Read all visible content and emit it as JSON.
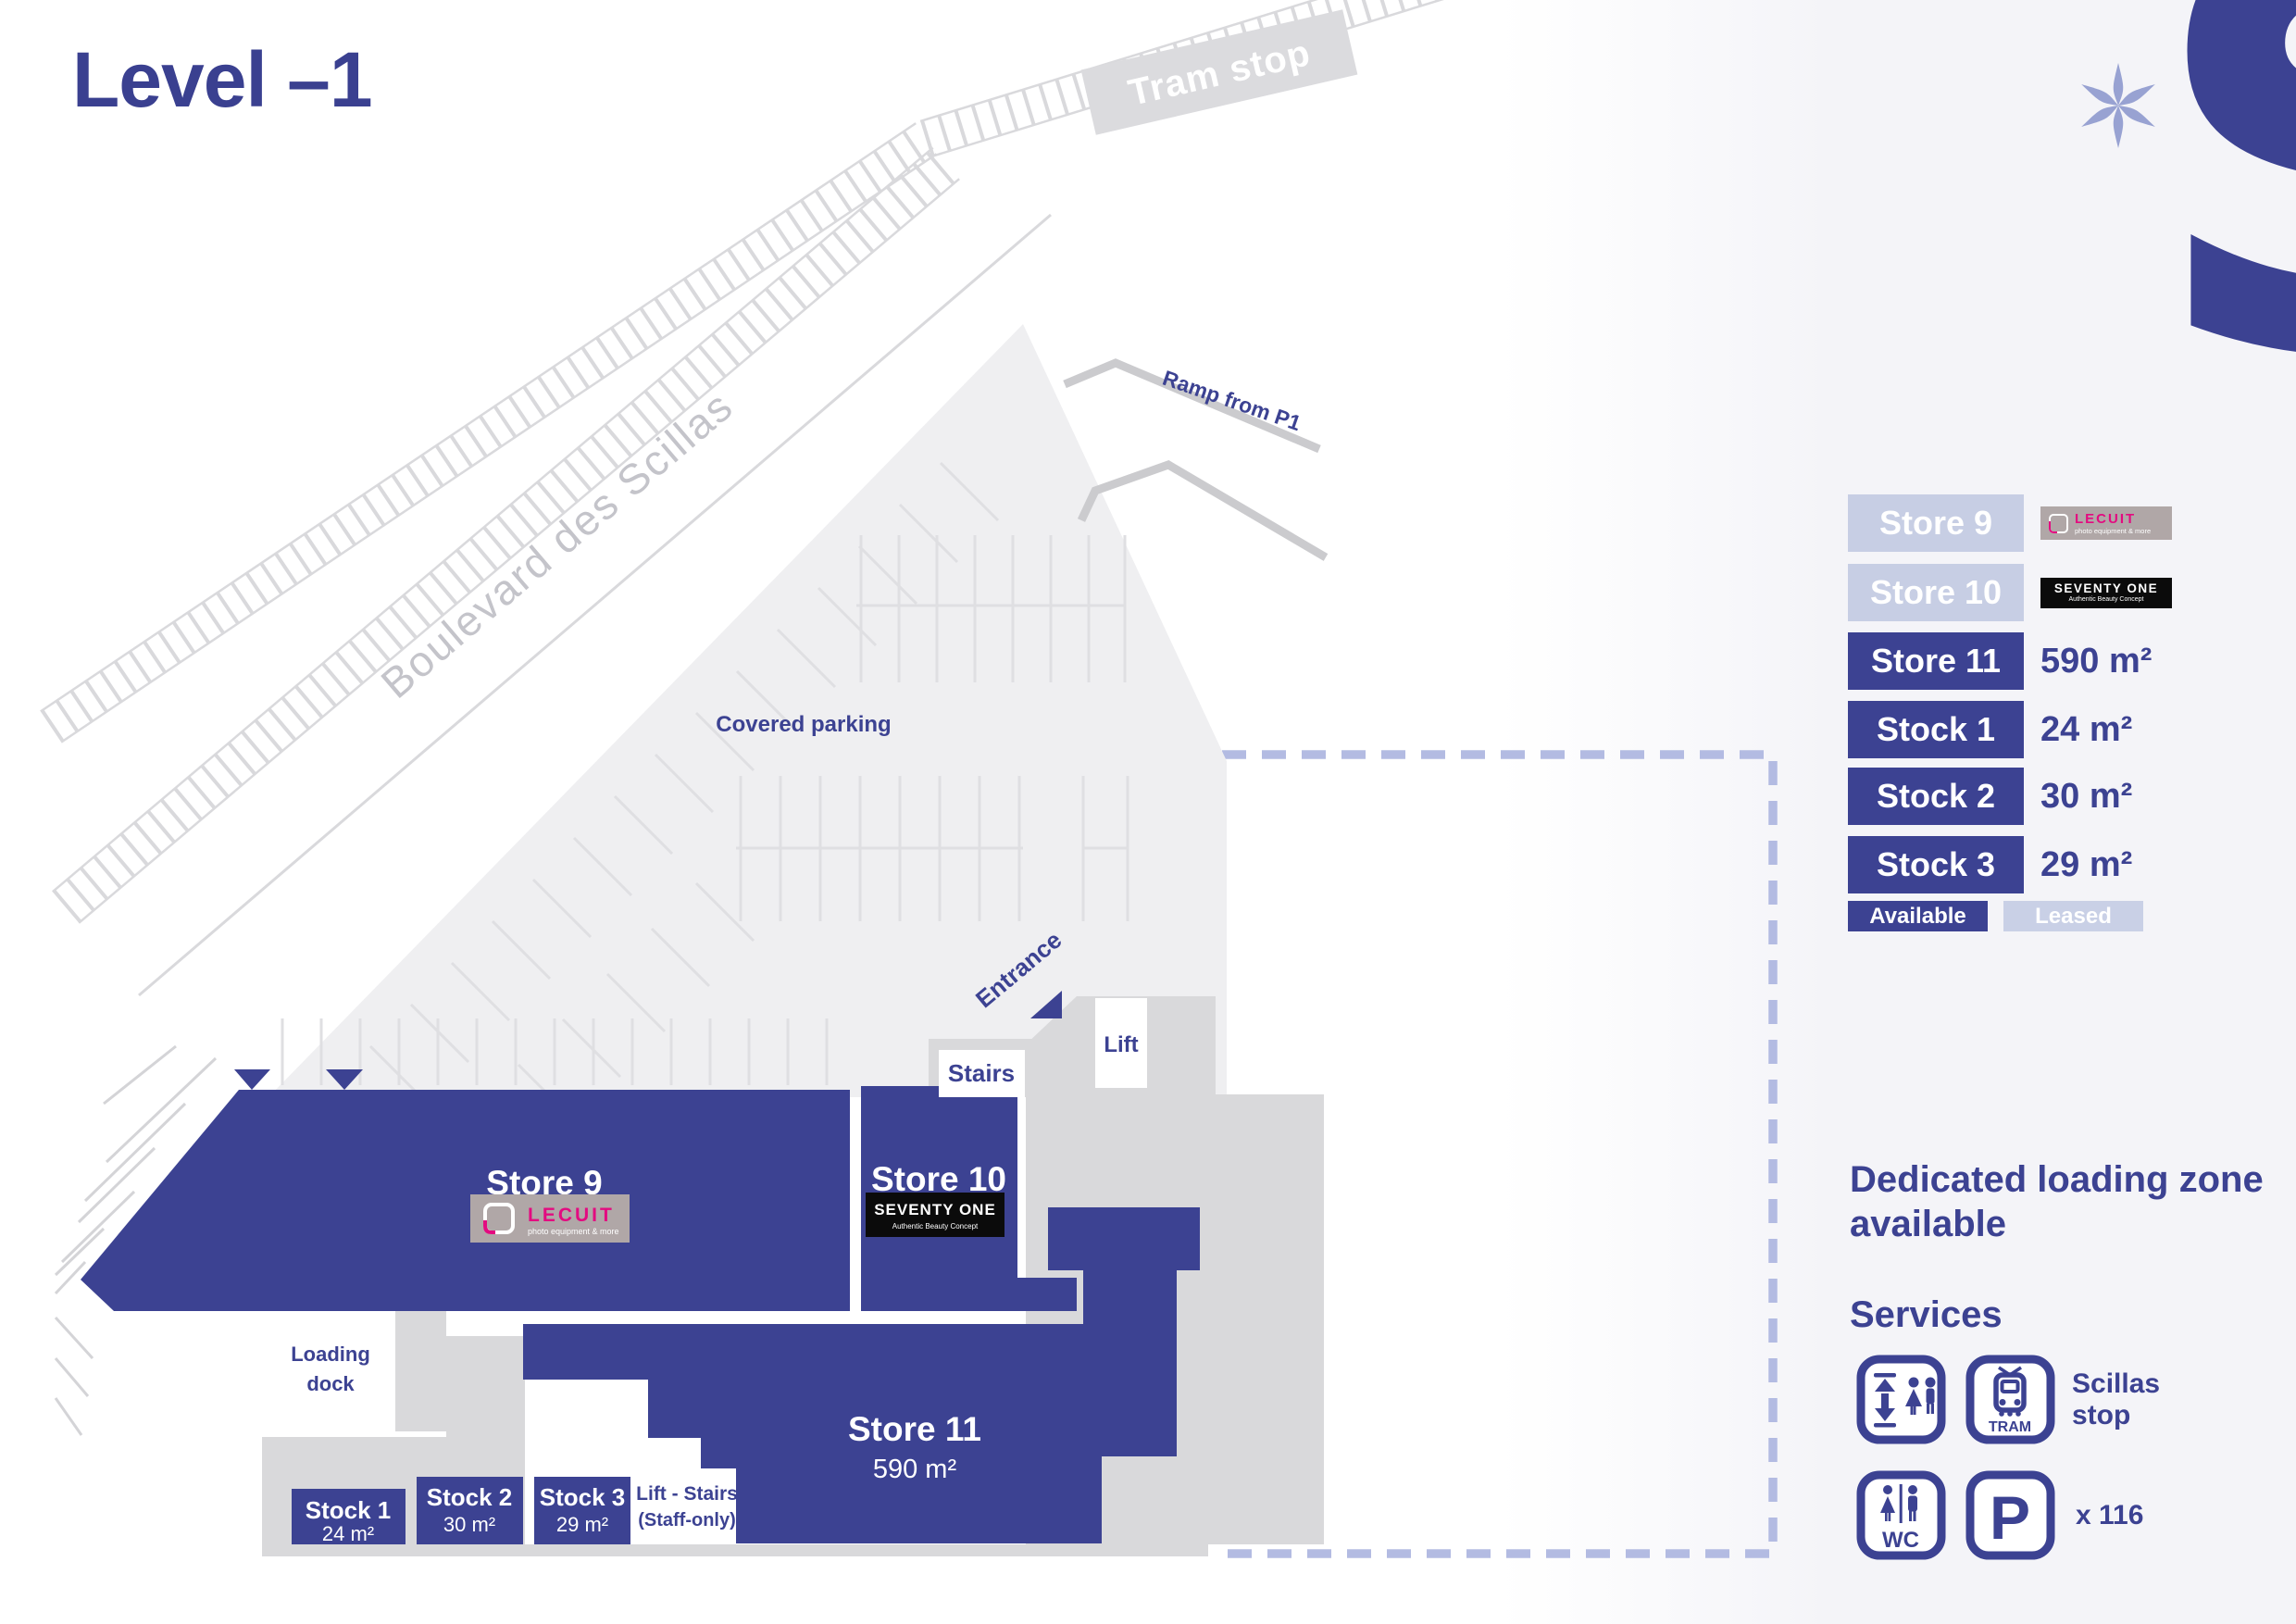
{
  "title": "Level –1",
  "logo": {
    "letter": "S"
  },
  "map": {
    "tram_stop": "Tram stop",
    "boulevard": "Boulevard des Scillas",
    "ramp": "Ramp from P1",
    "covered_parking": "Covered parking",
    "entrance": "Entrance",
    "stairs": "Stairs",
    "lift": "Lift",
    "loading_dock_line1": "Loading",
    "loading_dock_line2": "dock",
    "staff_lift_line1": "Lift - Stairs",
    "staff_lift_line2": "(Staff-only)",
    "store9": {
      "name": "Store 9"
    },
    "store10": {
      "name": "Store 10"
    },
    "store11": {
      "name": "Store 11",
      "area": "590 m²"
    },
    "stock1": {
      "name": "Stock 1",
      "area": "24 m²"
    },
    "stock2": {
      "name": "Stock 2",
      "area": "30 m²"
    },
    "stock3": {
      "name": "Stock 3",
      "area": "29 m²"
    }
  },
  "logos": {
    "lecuit": {
      "name": "LECUIT",
      "tagline": "photo equipment & more"
    },
    "seventyone": {
      "name": "SEVENTY ONE",
      "tagline": "Authentic Beauty Concept"
    }
  },
  "legend": {
    "rows": [
      {
        "label": "Store 9",
        "status": "leased"
      },
      {
        "label": "Store 10",
        "status": "leased"
      },
      {
        "label": "Store 11",
        "status": "available",
        "area": "590 m²"
      },
      {
        "label": "Stock 1",
        "status": "available",
        "area": "24 m²"
      },
      {
        "label": "Stock 2",
        "status": "available",
        "area": "30 m²"
      },
      {
        "label": "Stock 3",
        "status": "available",
        "area": "29 m²"
      }
    ],
    "available_label": "Available",
    "leased_label": "Leased"
  },
  "panel": {
    "loading_zone": "Dedicated loading zone available",
    "services_title": "Services",
    "tram_stop_label": "Scillas stop",
    "parking_count": "x 116",
    "tram_text": "TRAM",
    "wc_text": "WC",
    "p_text": "P"
  },
  "colors": {
    "brand_blue": "#3c4292",
    "leased_blue": "#c7cee4",
    "panel_bg": "#f4f4f8",
    "parking_gray": "#efeff1",
    "corridor_gray": "#d9d9db",
    "lecuit_pink": "#e30b80",
    "lecuit_bg": "#b0a7a7",
    "dash_blue": "#b3bbe2"
  }
}
